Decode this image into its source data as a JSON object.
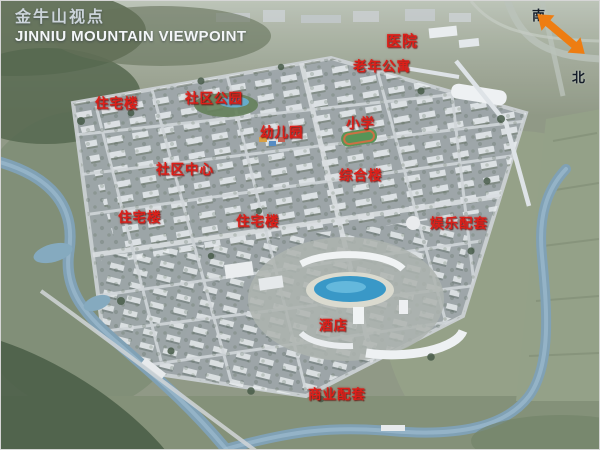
{
  "title": {
    "cn": "金牛山视点",
    "en": "JINNIU MOUNTAIN VIEWPOINT"
  },
  "compass": {
    "south": "南",
    "north": "北"
  },
  "labels": [
    {
      "text": "医院"
    },
    {
      "text": "老年公寓"
    },
    {
      "text": "住宅楼"
    },
    {
      "text": "社区公园"
    },
    {
      "text": "幼儿园"
    },
    {
      "text": "小学"
    },
    {
      "text": "社区中心"
    },
    {
      "text": "综合楼"
    },
    {
      "text": "住宅楼"
    },
    {
      "text": "住宅楼"
    },
    {
      "text": "娱乐配套"
    },
    {
      "text": "酒店"
    },
    {
      "text": "商业配套"
    }
  ],
  "colors": {
    "label_red": "#dd1f19",
    "compass_orange": "#ee7d12",
    "title_color": "#f3f6f8",
    "water_blue": "#7a9cb2",
    "lagoon_blue": "#2f93c5"
  }
}
